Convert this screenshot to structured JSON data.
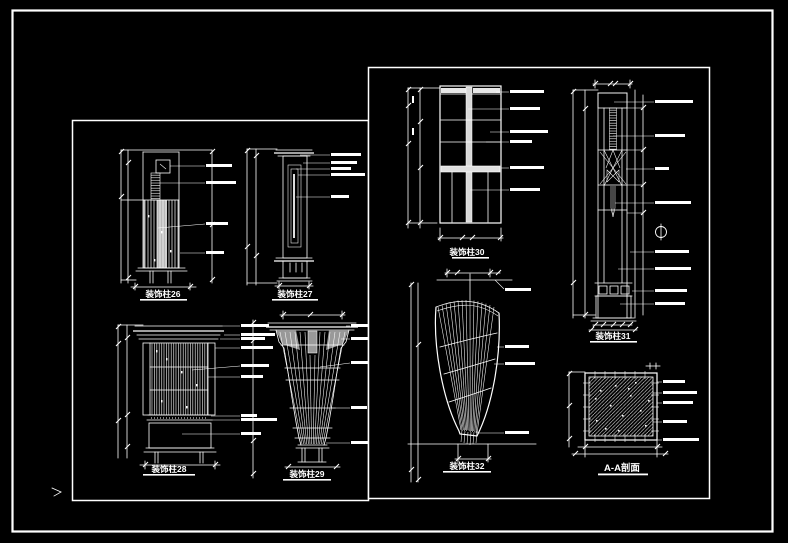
{
  "sheet": {
    "background_color": "#000000",
    "line_color": "#ffffff"
  },
  "panels": {
    "left": {
      "drawings": [
        {
          "id": "26",
          "title": "装饰柱26"
        },
        {
          "id": "27",
          "title": "装饰柱27"
        },
        {
          "id": "28",
          "title": "装饰柱28"
        },
        {
          "id": "29",
          "title": "装饰柱29"
        }
      ]
    },
    "right": {
      "drawings": [
        {
          "id": "30",
          "title": "装饰柱30"
        },
        {
          "id": "31",
          "title": "装饰柱31"
        },
        {
          "id": "32",
          "title": "装饰柱32"
        },
        {
          "id": "AA",
          "title": "A-A剖面"
        }
      ]
    }
  }
}
